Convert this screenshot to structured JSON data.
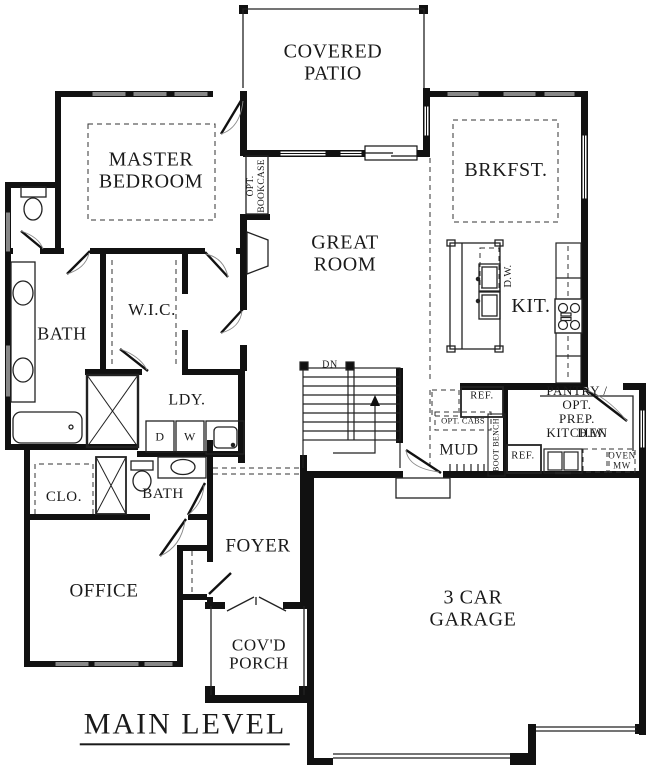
{
  "title": "MAIN LEVEL",
  "rooms": {
    "covered_patio": "COVERED\nPATIO",
    "master_bedroom": "MASTER\nBEDROOM",
    "great_room": "GREAT\nROOM",
    "brkfst": "BRKFST.",
    "kit": "KIT.",
    "bath": "BATH",
    "wic": "W.I.C.",
    "ldy": "LDY.",
    "mud": "MUD",
    "pantry": "PANTRY / OPT.\nPREP. KITCHEN",
    "pantry_dw": "D.W.",
    "clo": "CLO.",
    "bath2": "BATH",
    "office": "OFFICE",
    "foyer": "FOYER",
    "covd_porch": "COV'D\nPORCH",
    "garage": "3 CAR\nGARAGE"
  },
  "fixtures": {
    "opt_bookcase": "OPT.\nBOOKCASE",
    "island_dw": "D.W.",
    "stairs_dn": "DN",
    "ref_mud": "REF.",
    "ref_pantry": "REF.",
    "opt_cabs": "OPT. CABS",
    "boot_bench": "BOOT BENCH",
    "oven_mw": "OVEN\nMW",
    "dryer": "D",
    "washer": "W"
  },
  "colors": {
    "wall": "#111111",
    "line": "#222222",
    "dash": "#333333"
  }
}
